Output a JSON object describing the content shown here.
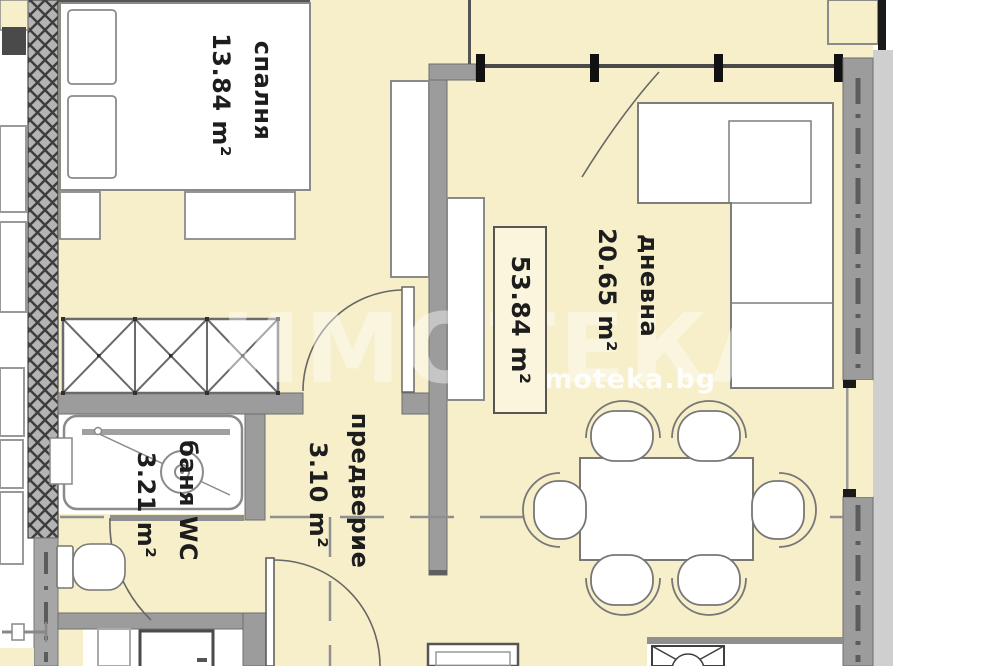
{
  "plan": {
    "title": "apartment-floor-plan",
    "total": {
      "area": "53.84 m²"
    },
    "rooms": {
      "bedroom": {
        "name": "спалня",
        "area": "13.84 m²"
      },
      "living": {
        "name": "дневна",
        "area": "20.65 m²"
      },
      "hall": {
        "name": "предверие",
        "area": "3.10 m²"
      },
      "bath": {
        "name": "баня WC",
        "area": "3.21 m²"
      }
    },
    "watermark": {
      "large": "ИМОТЕКА",
      "small": "imoteka.bg"
    },
    "colors": {
      "floor": "#f6efc9",
      "wall": "#9c9c9c",
      "wall_hatch": "#b4b4b4",
      "wall_dark_dash": "#5c5c5c",
      "outer_strip": "#cfcfcf",
      "furniture_outline": "#808080",
      "window_tick": "#111111",
      "label_text": "#1d1d1d",
      "watermark": "#ffffff"
    }
  }
}
